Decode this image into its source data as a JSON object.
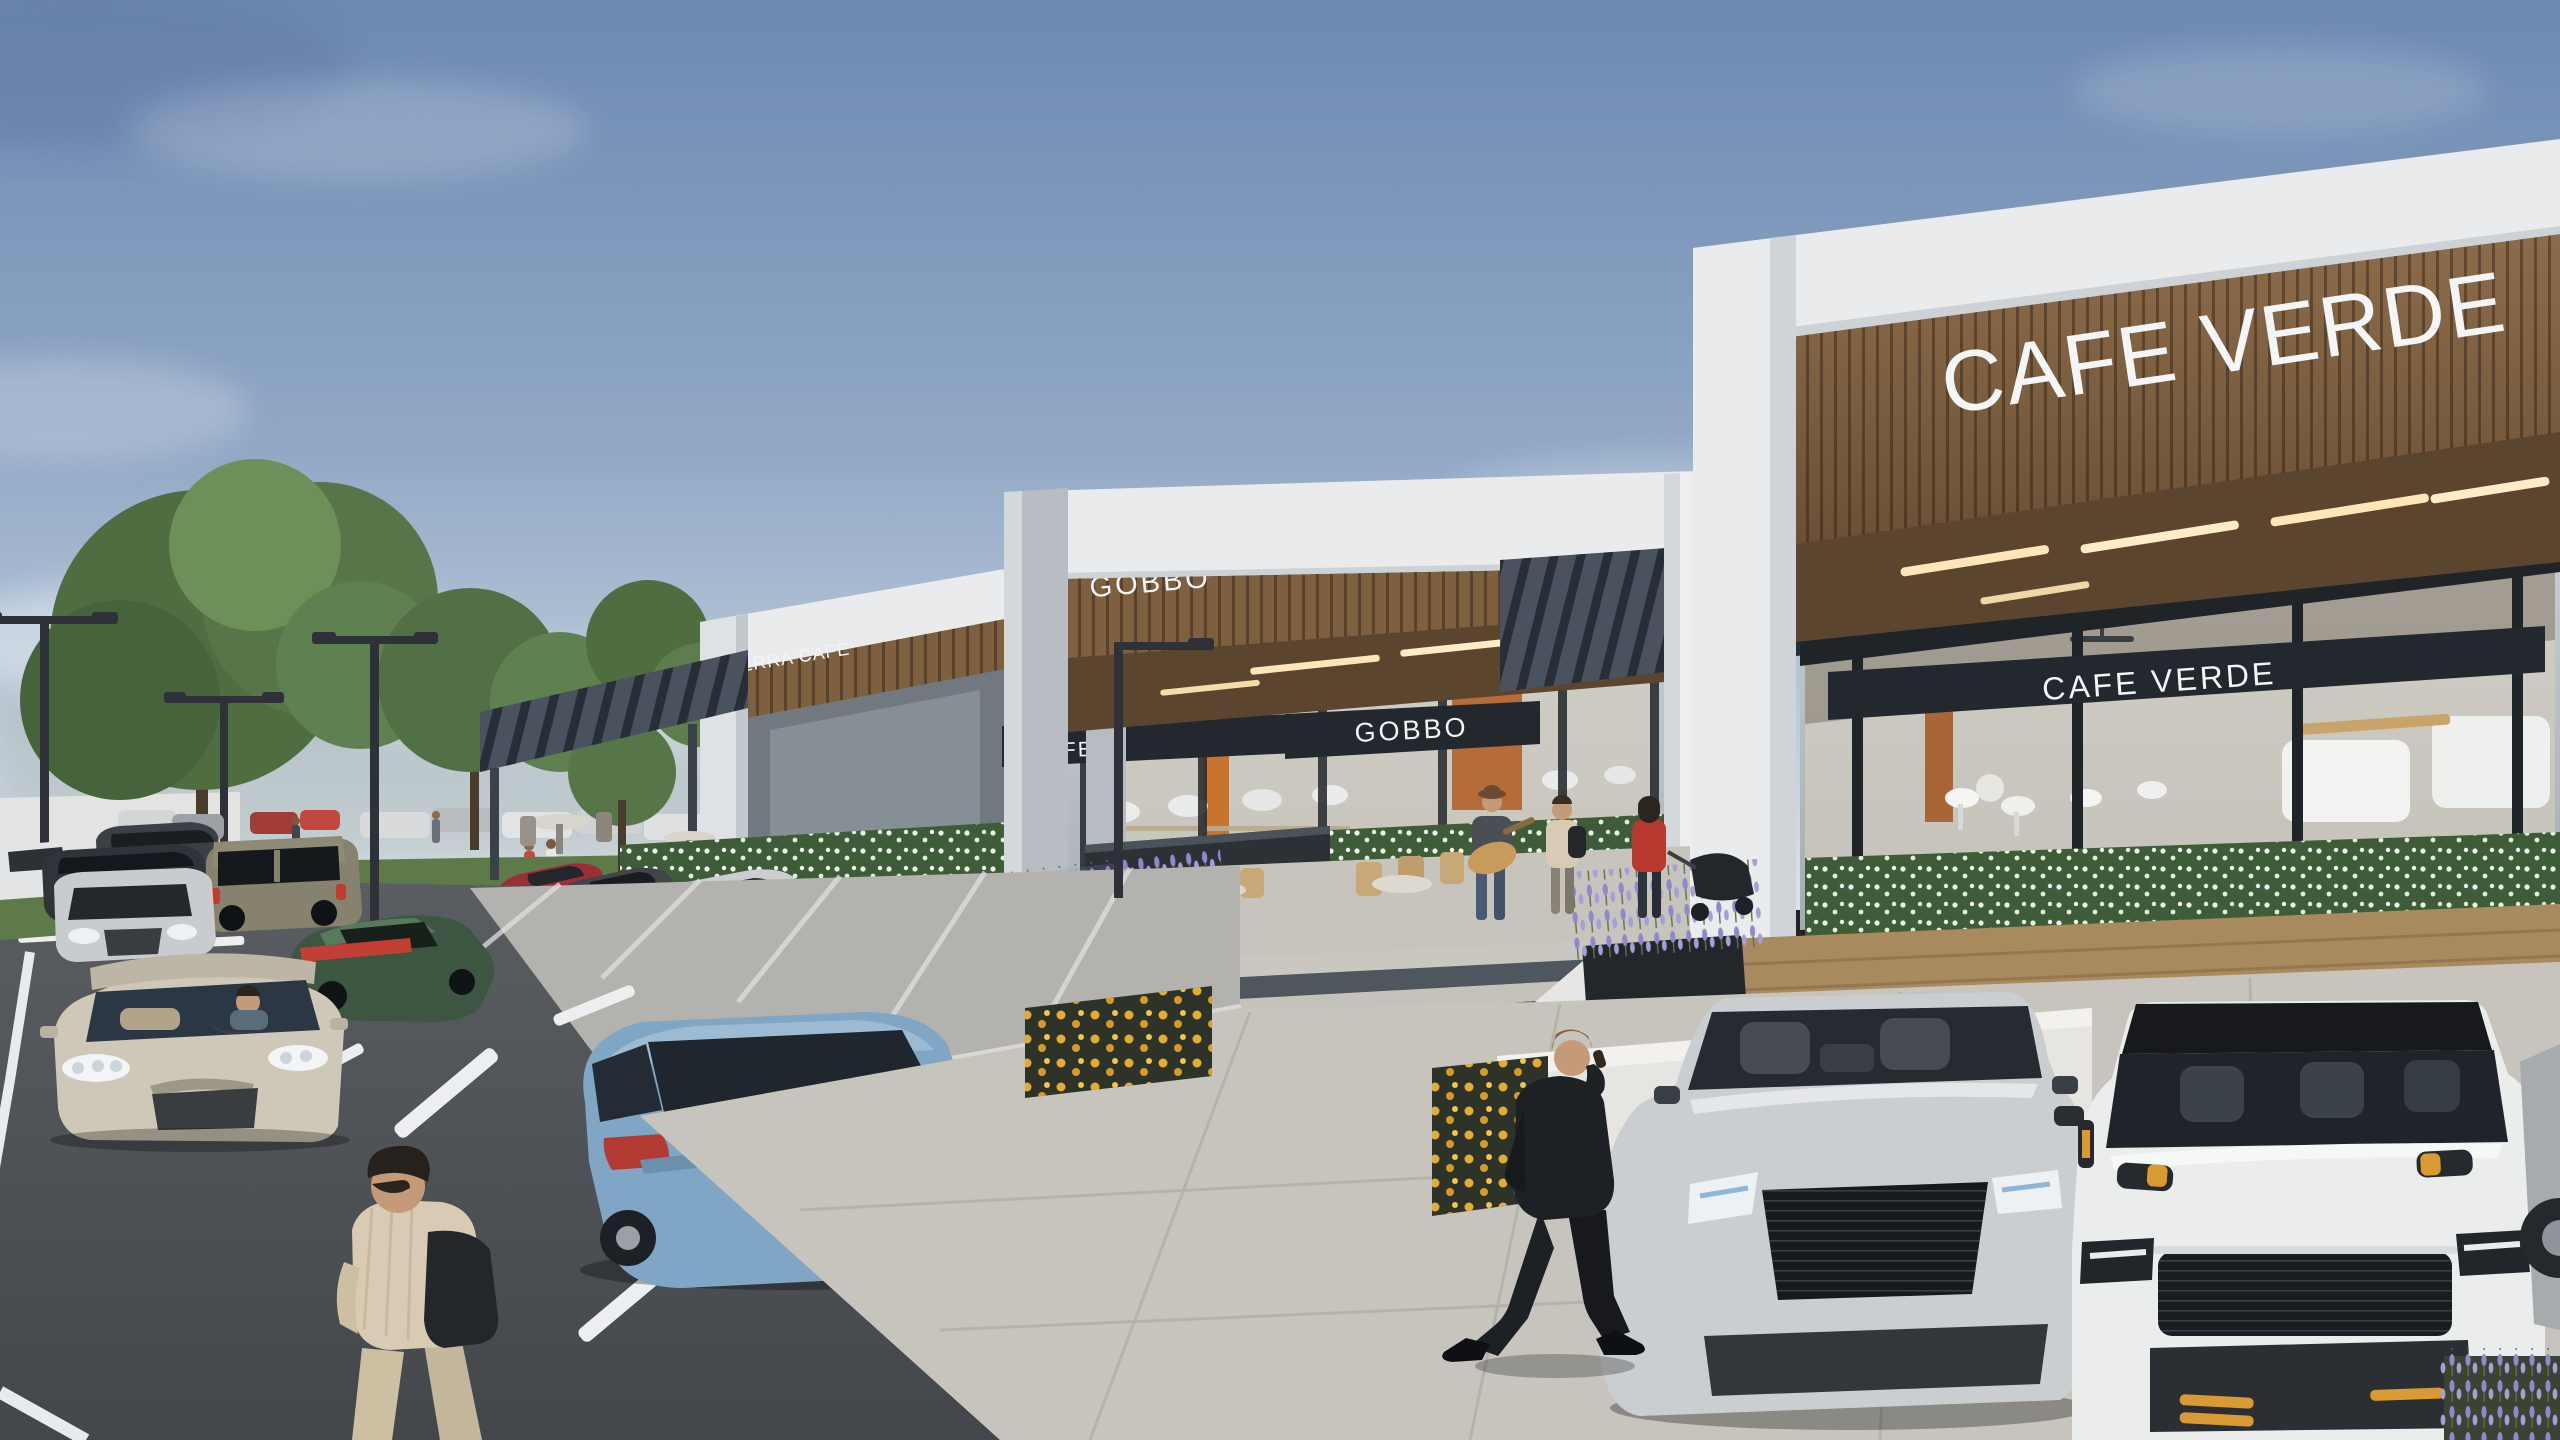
{
  "signs": {
    "terra_cafe_canopy": "TERRA CAFE",
    "gobbo_canopy": "GOBBO",
    "gobbo_band": "GOBBO",
    "cafe_band_partial": "CAFE",
    "cafe_verde_canopy": "CAFE VERDE",
    "cafe_verde_band": "CAFE VERDE"
  },
  "palette": {
    "sky_top": "#6d89b2",
    "sky_mid": "#92a9c6",
    "sky_horizon": "#dde3e9",
    "stone_white": "#e9ebec",
    "stone_shadow": "#c9ced3",
    "wood_canopy": "#7e5f40",
    "wood_soffit": "#5c452f",
    "soffit_light": "#ffe6b8",
    "pergola_dark": "#49525e",
    "sign_band_dark": "#23282e",
    "sign_text": "#f4f5f6",
    "glass_tint": "#b7c0c6",
    "interior_warm": "#d8cfbe",
    "interior_orange": "#b4642c",
    "hedge_green": "#3f5c38",
    "flower_white": "#eef3ec",
    "flower_yellow": "#e6ab31",
    "lavender": "#9188cc",
    "grass_green": "#5e7a48",
    "tree_green": "#4e6d41",
    "tree_light": "#6d9058",
    "asphalt": "#5a5e63",
    "asphalt_dark": "#43474b",
    "paving_light": "#c7c4be",
    "stall_surface": "#b4b2ae",
    "lane_marking": "#eceeef",
    "deck_wood": "#a98a5e",
    "car_beige": "#cfc8b8",
    "car_blue": "#7fa6c4",
    "car_silver": "#cbced1",
    "car_white_suv": "#ebecec",
    "car_green": "#3c5642",
    "car_red": "#9c2f36",
    "car_dark": "#2b3036",
    "car_navy": "#3a4049",
    "humvee_olive": "#86826e",
    "accent_orange": "#d99a33",
    "suit_black": "#1d2024",
    "skin": "#c59a78",
    "red_jacket": "#b8372f",
    "shirt_beige": "#d9cab4"
  },
  "objects": {
    "vehicles": [
      "beige-sedan",
      "blue-sedan",
      "white-range-rover",
      "silver-audi-sedan",
      "military-utility-vehicle",
      "green-sports-car",
      "red-sports-car",
      "grey-sports-car",
      "silver-sedan-parked",
      "black-coupe",
      "dark-blue-sedan",
      "white-sports-car",
      "distant-parked-cars"
    ],
    "people": [
      "man-in-suit-on-phone",
      "pedestrian-crossing-street",
      "woman-in-hijab",
      "street-guitarist",
      "man-with-backpack",
      "woman-with-stroller",
      "two-backpackers",
      "distant-pedestrians",
      "driver-in-beige-sedan"
    ],
    "landscape": [
      "street-trees",
      "lavender-planters",
      "marigold-beds",
      "white-flower-hedges",
      "grass-median",
      "street-lights",
      "stairs-to-plaza"
    ]
  }
}
